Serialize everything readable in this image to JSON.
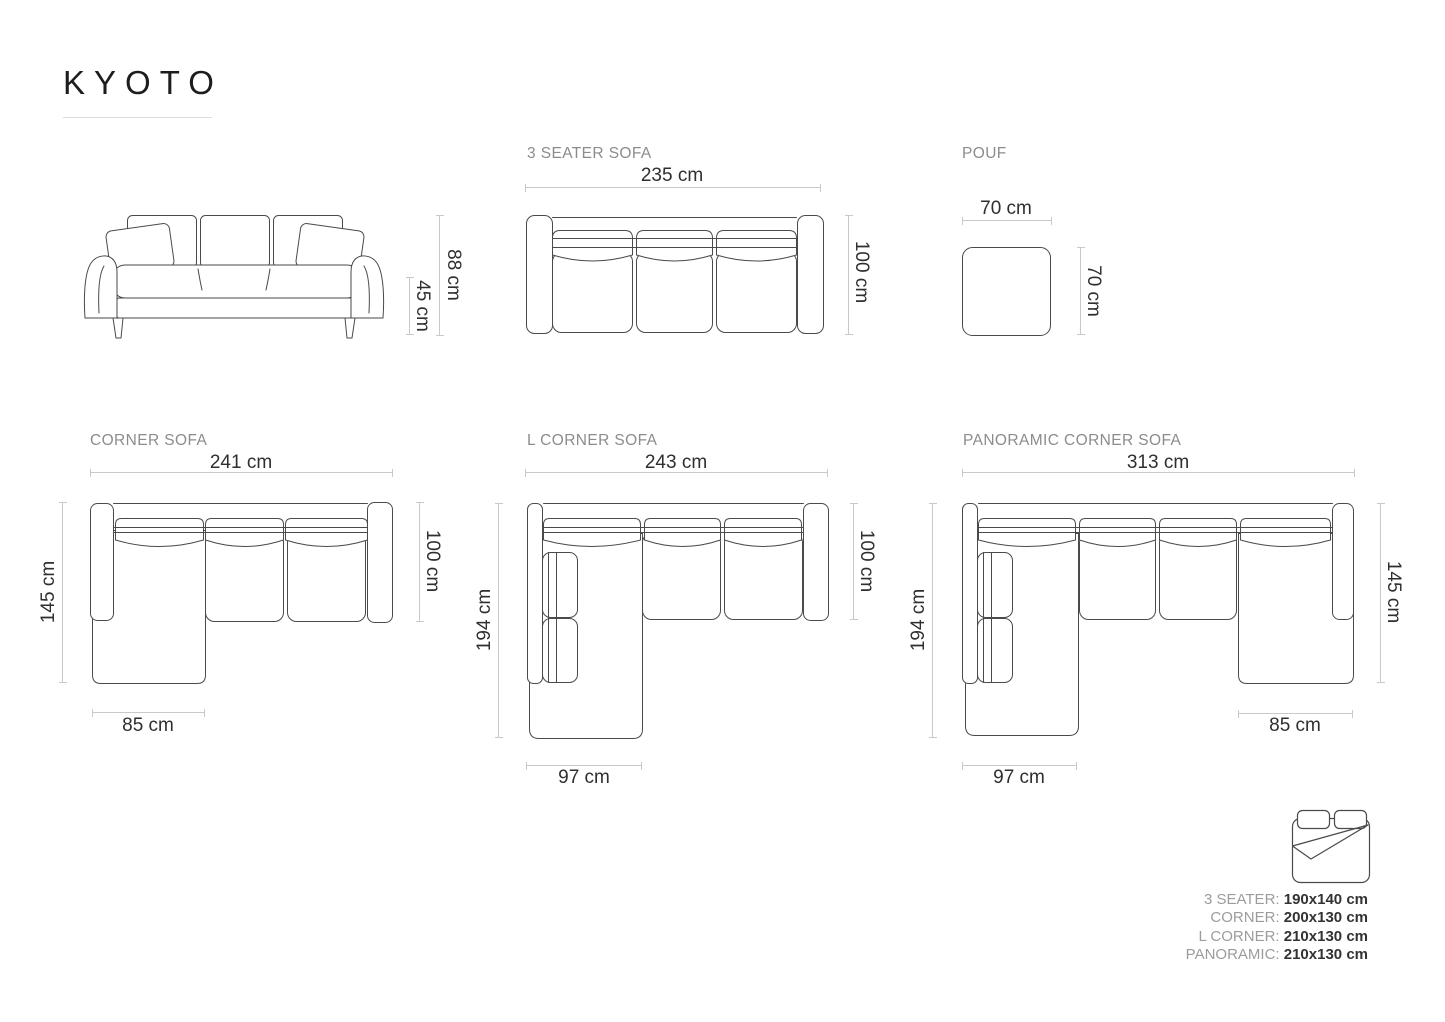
{
  "page": {
    "title": "KYOTO"
  },
  "colors": {
    "furniture_line": "#4a4a4a",
    "dimension_line": "#c9c9c9",
    "dimension_text": "#2f2f2f",
    "section_title": "#8c8c8c",
    "legend_label": "#9c9c9c",
    "legend_value": "#333333"
  },
  "front_view": {
    "height": "88 cm",
    "seat_height": "45 cm"
  },
  "three_seater": {
    "title": "3 SEATER SOFA",
    "width": "235 cm",
    "depth": "100 cm"
  },
  "pouf": {
    "title": "POUF",
    "width": "70 cm",
    "depth": "70 cm"
  },
  "corner": {
    "title": "CORNER SOFA",
    "width": "241 cm",
    "left_depth": "145 cm",
    "right_depth": "100 cm",
    "chaise_width": "85 cm"
  },
  "l_corner": {
    "title": "L CORNER SOFA",
    "width": "243 cm",
    "left_depth": "194 cm",
    "right_depth": "100 cm",
    "wing_width": "97 cm"
  },
  "panoramic": {
    "title": "PANORAMIC CORNER SOFA",
    "width": "313 cm",
    "left_depth": "194 cm",
    "right_depth": "145 cm",
    "wing_width": "97 cm",
    "chaise_width": "85 cm"
  },
  "bed_sizes": {
    "icon": "bed-icon",
    "rows": [
      {
        "label": "3 SEATER:",
        "value": "190x140 cm"
      },
      {
        "label": "CORNER:",
        "value": "200x130 cm"
      },
      {
        "label": "L CORNER:",
        "value": "210x130 cm"
      },
      {
        "label": "PANORAMIC:",
        "value": "210x130 cm"
      }
    ]
  }
}
